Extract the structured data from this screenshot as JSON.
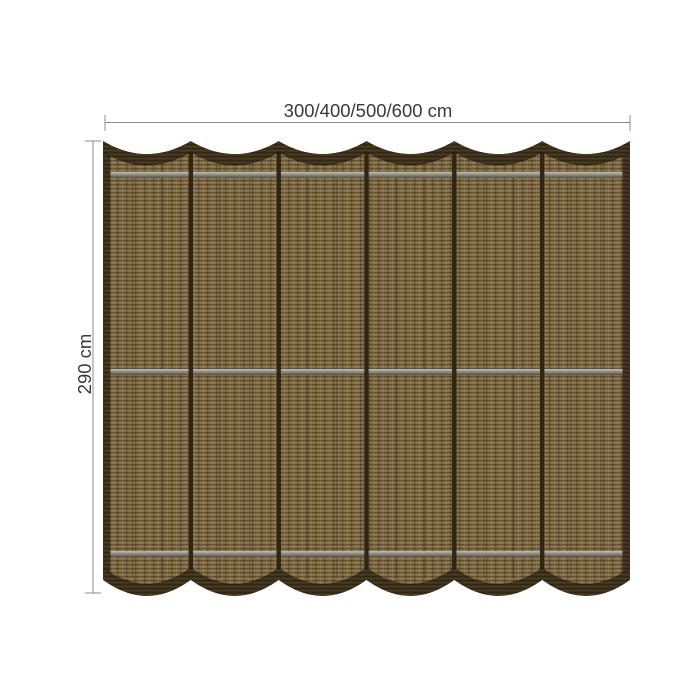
{
  "diagram": {
    "title": "shade cloth with dimension annotations",
    "width_label": "300/400/500/600 cm",
    "height_label": "290 cm",
    "panel_count": 6,
    "support_bar_count": 3,
    "colors": {
      "fabric_base": "#7e6a44",
      "weave_dark": "#59492b",
      "weave_light": "#947d52",
      "binding": "#3d311c",
      "binding_dark": "#2c2312",
      "binding_light": "#4e3f25",
      "seam": "#2f2614",
      "bar_light": "#c2c0b8",
      "bar_mid": "#8f8c83",
      "bar_dark": "#554f45",
      "dimension_line": "#8c8c8c",
      "label_text": "#3a3a3a"
    }
  }
}
